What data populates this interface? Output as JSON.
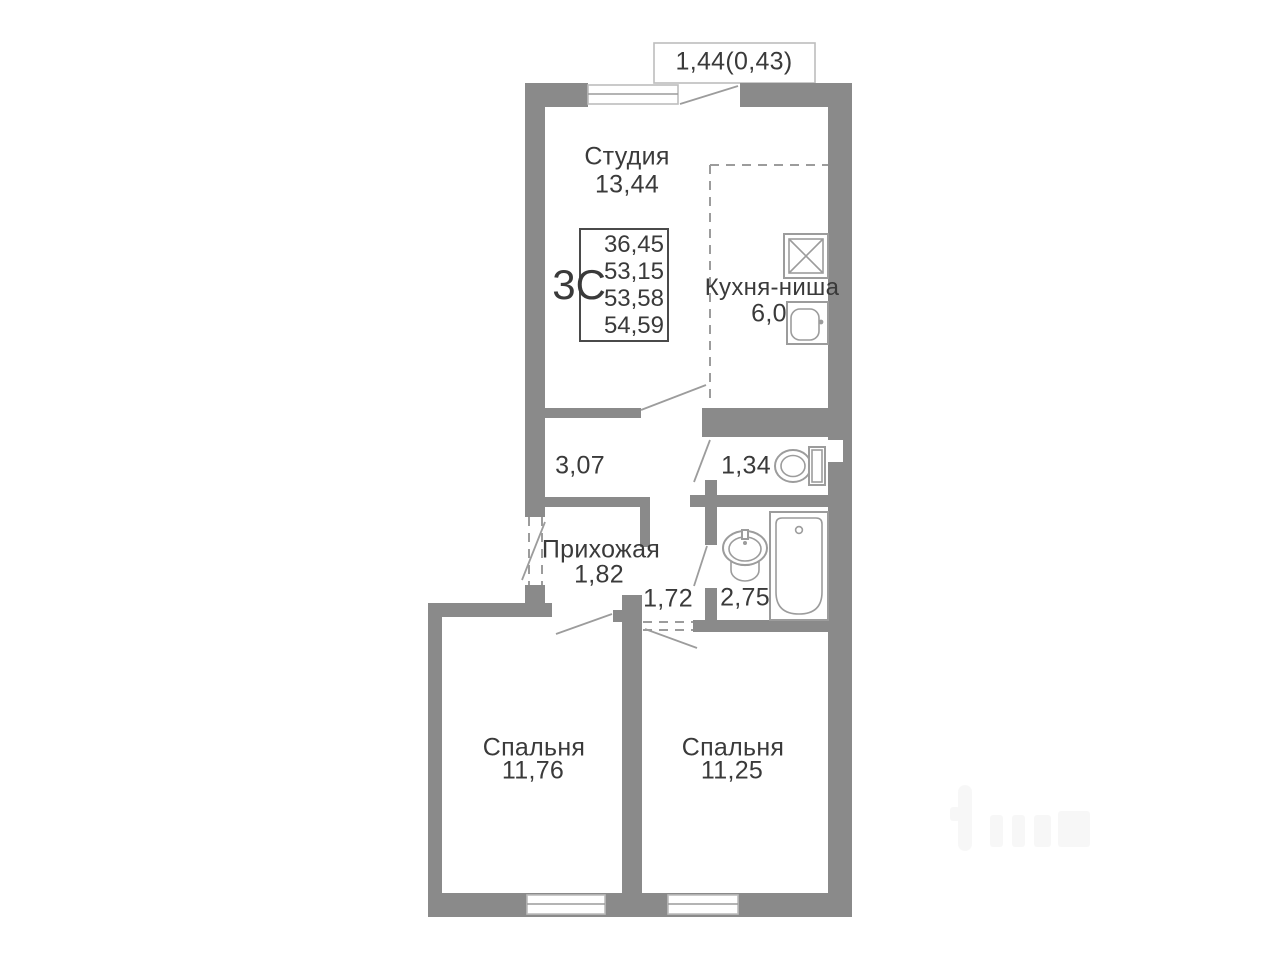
{
  "plan": {
    "balcony": {
      "label": "1,44(0,43)"
    },
    "stamp": {
      "type_label": "3С",
      "areas": [
        "36,45",
        "53,15",
        "53,58",
        "54,59"
      ]
    },
    "rooms": {
      "studio": {
        "name": "Студия",
        "area": "13,44"
      },
      "kitchen": {
        "name": "Кухня-ниша",
        "area": "6,0"
      },
      "corridor": {
        "area": "3,07"
      },
      "wc": {
        "area": "1,34"
      },
      "hallway": {
        "name": "Прихожая",
        "area": "1,82"
      },
      "lobby": {
        "area": "1,72"
      },
      "bathroom": {
        "area": "2,75"
      },
      "bedroom1": {
        "name": "Спальня",
        "area": "11,76"
      },
      "bedroom2": {
        "name": "Спальня",
        "area": "11,25"
      }
    }
  },
  "colors": {
    "wall": "#8a8a8a",
    "line": "#9c9c9c",
    "thin": "#bdbdbd",
    "text": "#3a3a3a",
    "stamp": "#4a4a4a"
  }
}
